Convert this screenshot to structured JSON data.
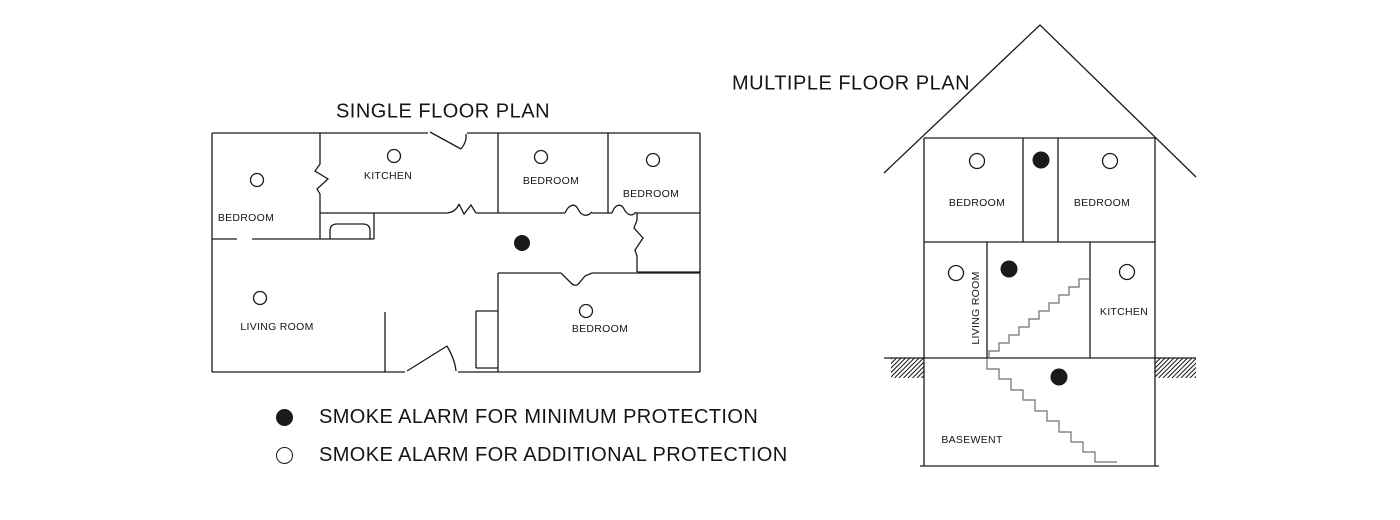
{
  "colors": {
    "background": "#ffffff",
    "line": "#1a1a1a",
    "stair": "#6f6f6f",
    "text": "#14141a"
  },
  "single_plan": {
    "title": "SINGLE FLOOR PLAN",
    "rooms": [
      {
        "label": "BEDROOM",
        "x": 246,
        "y": 218
      },
      {
        "label": "KITCHEN",
        "x": 388,
        "y": 176
      },
      {
        "label": "BEDROOM",
        "x": 551,
        "y": 181
      },
      {
        "label": "BEDROOM",
        "x": 651,
        "y": 194
      },
      {
        "label": "LIVING ROOM",
        "x": 277,
        "y": 327
      },
      {
        "label": "BEDROOM",
        "x": 600,
        "y": 329
      }
    ],
    "alarms": [
      {
        "type": "open",
        "x": 257,
        "y": 180
      },
      {
        "type": "open",
        "x": 394,
        "y": 156
      },
      {
        "type": "open",
        "x": 541,
        "y": 157
      },
      {
        "type": "open",
        "x": 653,
        "y": 160
      },
      {
        "type": "open",
        "x": 260,
        "y": 298
      },
      {
        "type": "open",
        "x": 586,
        "y": 311
      },
      {
        "type": "filled",
        "x": 522,
        "y": 243
      }
    ]
  },
  "multiple_plan": {
    "title": "MULTIPLE FLOOR PLAN",
    "rooms": [
      {
        "label": "BEDROOM",
        "x": 977,
        "y": 203
      },
      {
        "label": "BEDROOM",
        "x": 1102,
        "y": 203
      },
      {
        "label": "LIVING ROOM",
        "x": 976,
        "y": 308,
        "rotate": true
      },
      {
        "label": "KITCHEN",
        "x": 1124,
        "y": 312
      },
      {
        "label": "BASEWENT",
        "x": 972,
        "y": 440
      }
    ],
    "alarms": [
      {
        "type": "open",
        "x": 977,
        "y": 161
      },
      {
        "type": "filled",
        "x": 1041,
        "y": 160
      },
      {
        "type": "open",
        "x": 1110,
        "y": 161
      },
      {
        "type": "open",
        "x": 956,
        "y": 273
      },
      {
        "type": "filled",
        "x": 1009,
        "y": 269
      },
      {
        "type": "open",
        "x": 1127,
        "y": 272
      },
      {
        "type": "filled",
        "x": 1059,
        "y": 377
      }
    ]
  },
  "legend": {
    "items": [
      {
        "marker": "filled",
        "label": "SMOKE ALARM FOR MINIMUM PROTECTION"
      },
      {
        "marker": "open",
        "label": "SMOKE ALARM FOR ADDITIONAL PROTECTION"
      }
    ]
  }
}
